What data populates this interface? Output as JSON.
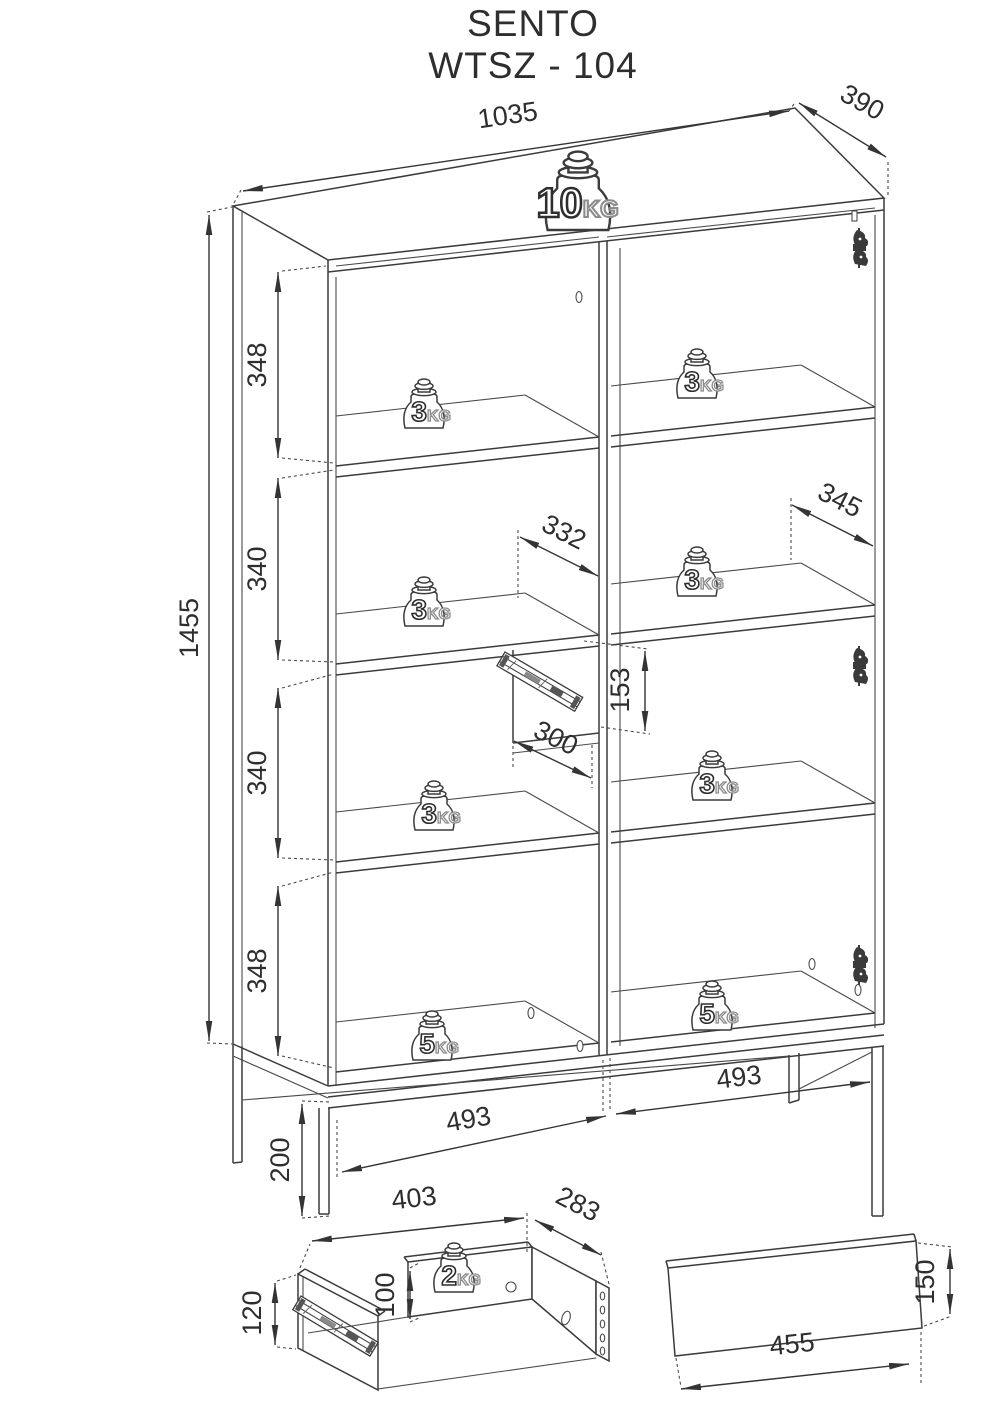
{
  "title": {
    "line1": "SENTO",
    "line2": "WTSZ - 104"
  },
  "dimensions": {
    "top_width": "1035",
    "top_depth": "390",
    "total_height": "1455",
    "sections": [
      "348",
      "340",
      "340",
      "348"
    ],
    "left_interior_width": "332",
    "right_interior_width": "345",
    "drawer_opening_height": "153",
    "drawer_opening_width": "300",
    "bottom_left_width": "493",
    "bottom_right_width": "493",
    "leg_height": "200"
  },
  "weights": {
    "top": {
      "value": "10",
      "unit": "KG"
    },
    "shelf": {
      "value": "3",
      "unit": "KG"
    },
    "bottom": {
      "value": "5",
      "unit": "KG"
    },
    "drawer": {
      "value": "2",
      "unit": "KG"
    }
  },
  "drawer_detail": {
    "width": "403",
    "depth": "283",
    "height": "120",
    "inner_height": "100"
  },
  "front_panel_detail": {
    "width": "455",
    "height": "150"
  }
}
